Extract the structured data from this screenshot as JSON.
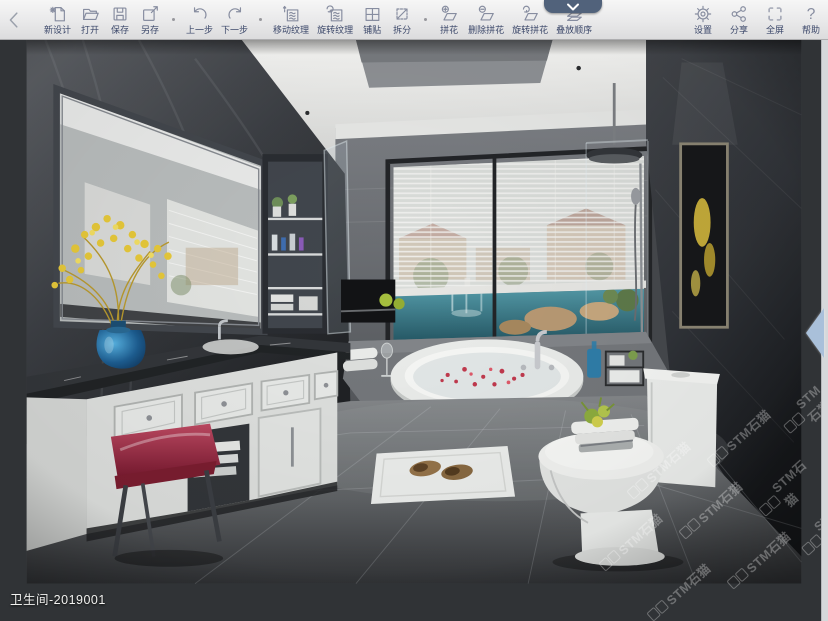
{
  "toolbar": {
    "back": {
      "icon": "chevron-left-icon"
    },
    "items": [
      {
        "id": "new-design",
        "label": "新设计",
        "icon": "new-file-icon"
      },
      {
        "id": "open",
        "label": "打开",
        "icon": "open-folder-icon"
      },
      {
        "id": "save",
        "label": "保存",
        "icon": "floppy-disk-icon"
      },
      {
        "id": "save-as",
        "label": "另存",
        "icon": "save-as-icon"
      },
      {
        "id": "undo",
        "label": "上一步",
        "icon": "undo-arrow-icon"
      },
      {
        "id": "redo",
        "label": "下一步",
        "icon": "redo-arrow-icon"
      },
      {
        "id": "move-texture",
        "label": "移动纹理",
        "icon": "move-texture-icon"
      },
      {
        "id": "rotate-texture",
        "label": "旋转纹理",
        "icon": "rotate-texture-icon"
      },
      {
        "id": "paving",
        "label": "铺贴",
        "icon": "tile-grid-icon"
      },
      {
        "id": "split",
        "label": "拆分",
        "icon": "split-icon"
      },
      {
        "id": "mosaic",
        "label": "拼花",
        "icon": "add-mosaic-icon"
      },
      {
        "id": "delete-mosaic",
        "label": "删除拼花",
        "icon": "delete-mosaic-icon"
      },
      {
        "id": "rotate-mosaic",
        "label": "旋转拼花",
        "icon": "rotate-mosaic-icon"
      },
      {
        "id": "stack-order",
        "label": "叠放顺序",
        "icon": "layers-icon"
      },
      {
        "id": "settings",
        "label": "设置",
        "icon": "gear-icon"
      },
      {
        "id": "share",
        "label": "分享",
        "icon": "share-icon"
      },
      {
        "id": "fullscreen",
        "label": "全屏",
        "icon": "fullscreen-icon"
      },
      {
        "id": "help",
        "label": "帮助",
        "icon": "question-icon",
        "glyph": "?"
      }
    ]
  },
  "canvas": {
    "project_label": "卫生间-2019001",
    "watermark": "STM石猫"
  },
  "colors": {
    "toolbar_label": "#3c486a",
    "tab_blue": "#51627b",
    "handle_blue": "#a9c0da"
  }
}
